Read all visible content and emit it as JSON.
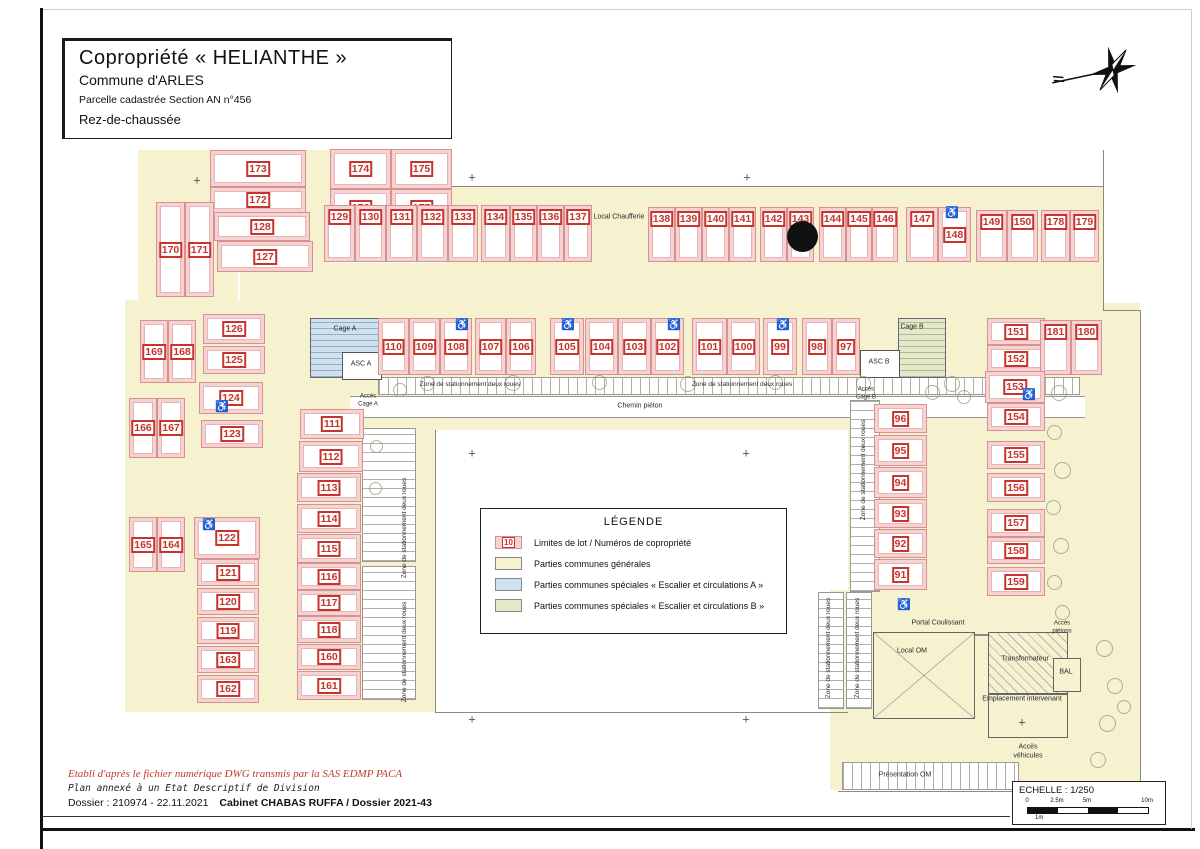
{
  "title_block": {
    "title": "Copropriété « HELIANTHE »",
    "subtitle": "Commune d'ARLES",
    "parcel": "Parcelle cadastrée Section AN n°456",
    "level": "Rez-de-chaussée"
  },
  "legend": {
    "title": "LÉGENDE",
    "items": [
      {
        "badge": "10",
        "label": "Limites de lot / Numéros de copropriété"
      },
      {
        "label": "Parties communes générales"
      },
      {
        "label": "Parties communes spéciales « Escalier et circulations A »"
      },
      {
        "label": "Parties communes spéciales « Escalier et circulations B »"
      }
    ]
  },
  "footer": {
    "line1": "Etabli d'après le fichier numérique DWG transmis par la SAS EDMP PACA",
    "line2": "Plan annexé à un Etat Descriptif de Division",
    "line3": "Dossier : 210974 - 22.11.2021",
    "line3_bold": "Cabinet CHABAS RUFFA / Dossier 2021-43"
  },
  "scale": {
    "label": "ECHELLE : 1/250",
    "ticks": [
      "0",
      "2.5m",
      "5m",
      "10m"
    ],
    "sub": "1m"
  },
  "colors": {
    "common_general": "#f6f2cf",
    "lot_fill": "#f5d3d3",
    "lot_number": "#c6342e",
    "stair_a": "#cfe0ee",
    "stair_b": "#e3e9c9"
  },
  "plan": {
    "lots_key": [
      "num",
      "x",
      "y",
      "w",
      "h",
      "labelPos"
    ],
    "lots": [
      [
        173,
        210,
        150,
        96,
        37,
        "c"
      ],
      [
        172,
        210,
        187,
        96,
        26,
        "c"
      ],
      [
        128,
        214,
        212,
        96,
        29,
        "c"
      ],
      [
        127,
        217,
        241,
        96,
        31,
        "c"
      ],
      [
        170,
        156,
        202,
        29,
        95,
        "c"
      ],
      [
        171,
        185,
        202,
        29,
        95,
        "c"
      ],
      [
        174,
        330,
        149,
        61,
        40,
        "c"
      ],
      [
        175,
        391,
        149,
        61,
        40,
        "c"
      ],
      [
        176,
        330,
        189,
        61,
        37,
        "c"
      ],
      [
        177,
        391,
        189,
        61,
        37,
        "c"
      ],
      [
        129,
        324,
        205,
        31,
        57,
        "t"
      ],
      [
        130,
        355,
        205,
        31,
        57,
        "t"
      ],
      [
        131,
        386,
        205,
        31,
        57,
        "t"
      ],
      [
        132,
        417,
        205,
        31,
        57,
        "t"
      ],
      [
        133,
        448,
        205,
        30,
        57,
        "t"
      ],
      [
        134,
        481,
        205,
        29,
        57,
        "t"
      ],
      [
        135,
        510,
        205,
        27,
        57,
        "t"
      ],
      [
        136,
        537,
        205,
        27,
        57,
        "t"
      ],
      [
        137,
        564,
        205,
        28,
        57,
        "t"
      ],
      [
        138,
        648,
        207,
        27,
        55,
        "t"
      ],
      [
        139,
        675,
        207,
        27,
        55,
        "t"
      ],
      [
        140,
        702,
        207,
        27,
        55,
        "t"
      ],
      [
        141,
        729,
        207,
        27,
        55,
        "t"
      ],
      [
        142,
        760,
        207,
        27,
        55,
        "t"
      ],
      [
        143,
        787,
        207,
        27,
        55,
        "t"
      ],
      [
        144,
        819,
        207,
        27,
        55,
        "t"
      ],
      [
        145,
        846,
        207,
        26,
        55,
        "t"
      ],
      [
        146,
        872,
        207,
        26,
        55,
        "t"
      ],
      [
        147,
        906,
        207,
        32,
        55,
        "t"
      ],
      [
        148,
        938,
        207,
        33,
        55,
        "c"
      ],
      [
        149,
        976,
        210,
        31,
        52,
        "t"
      ],
      [
        150,
        1007,
        210,
        31,
        52,
        "t"
      ],
      [
        178,
        1041,
        210,
        29,
        52,
        "t"
      ],
      [
        179,
        1070,
        210,
        29,
        52,
        "t"
      ],
      [
        169,
        140,
        320,
        28,
        63,
        "c"
      ],
      [
        168,
        168,
        320,
        28,
        63,
        "c"
      ],
      [
        126,
        203,
        314,
        62,
        30,
        "c"
      ],
      [
        125,
        203,
        346,
        62,
        28,
        "c"
      ],
      [
        124,
        199,
        382,
        64,
        32,
        "c"
      ],
      [
        123,
        201,
        420,
        62,
        28,
        "c"
      ],
      [
        166,
        129,
        398,
        28,
        60,
        "c"
      ],
      [
        167,
        157,
        398,
        28,
        60,
        "c"
      ],
      [
        165,
        129,
        517,
        28,
        55,
        "c"
      ],
      [
        164,
        157,
        517,
        28,
        55,
        "c"
      ],
      [
        122,
        194,
        517,
        66,
        42,
        "c"
      ],
      [
        121,
        197,
        559,
        62,
        27,
        "c"
      ],
      [
        120,
        197,
        588,
        62,
        27,
        "c"
      ],
      [
        119,
        197,
        617,
        62,
        27,
        "c"
      ],
      [
        163,
        197,
        646,
        62,
        27,
        "c"
      ],
      [
        162,
        197,
        675,
        62,
        28,
        "c"
      ],
      [
        111,
        300,
        409,
        64,
        30,
        "c"
      ],
      [
        112,
        299,
        441,
        64,
        31,
        "c"
      ],
      [
        113,
        297,
        473,
        64,
        29,
        "c"
      ],
      [
        114,
        297,
        504,
        64,
        29,
        "c"
      ],
      [
        115,
        297,
        534,
        64,
        29,
        "c"
      ],
      [
        116,
        297,
        563,
        64,
        27,
        "c"
      ],
      [
        117,
        297,
        590,
        64,
        26,
        "c"
      ],
      [
        118,
        297,
        616,
        64,
        27,
        "c"
      ],
      [
        160,
        297,
        644,
        64,
        26,
        "c"
      ],
      [
        161,
        297,
        671,
        64,
        29,
        "c"
      ],
      [
        110,
        378,
        318,
        31,
        57,
        "c"
      ],
      [
        109,
        409,
        318,
        31,
        57,
        "c"
      ],
      [
        108,
        440,
        318,
        32,
        57,
        "c"
      ],
      [
        107,
        475,
        318,
        31,
        57,
        "c"
      ],
      [
        106,
        506,
        318,
        30,
        57,
        "c"
      ],
      [
        105,
        550,
        318,
        34,
        57,
        "c"
      ],
      [
        104,
        585,
        318,
        33,
        57,
        "c"
      ],
      [
        103,
        618,
        318,
        33,
        57,
        "c"
      ],
      [
        102,
        651,
        318,
        33,
        57,
        "c"
      ],
      [
        101,
        692,
        318,
        35,
        57,
        "c"
      ],
      [
        100,
        727,
        318,
        33,
        57,
        "c"
      ],
      [
        99,
        763,
        318,
        34,
        57,
        "c"
      ],
      [
        98,
        802,
        318,
        30,
        57,
        "c"
      ],
      [
        97,
        832,
        318,
        28,
        57,
        "c"
      ],
      [
        96,
        874,
        404,
        53,
        29,
        "c"
      ],
      [
        95,
        874,
        435,
        53,
        31,
        "c"
      ],
      [
        94,
        874,
        467,
        53,
        31,
        "c"
      ],
      [
        93,
        874,
        499,
        53,
        29,
        "c"
      ],
      [
        92,
        874,
        529,
        53,
        29,
        "c"
      ],
      [
        91,
        874,
        559,
        53,
        31,
        "c"
      ],
      [
        151,
        987,
        318,
        58,
        27,
        "c"
      ],
      [
        152,
        987,
        345,
        58,
        27,
        "c"
      ],
      [
        181,
        1040,
        320,
        31,
        55,
        "t"
      ],
      [
        180,
        1071,
        320,
        31,
        55,
        "t"
      ],
      [
        153,
        985,
        371,
        60,
        32,
        "c"
      ],
      [
        154,
        987,
        403,
        58,
        28,
        "c"
      ],
      [
        155,
        987,
        441,
        58,
        28,
        "c"
      ],
      [
        156,
        987,
        473,
        58,
        29,
        "c"
      ],
      [
        157,
        987,
        509,
        58,
        28,
        "c"
      ],
      [
        158,
        987,
        537,
        58,
        27,
        "c"
      ],
      [
        159,
        987,
        567,
        58,
        29,
        "c"
      ]
    ],
    "zones": [
      [
        138,
        150,
        100,
        153
      ],
      [
        306,
        150,
        24,
        153
      ],
      [
        445,
        186,
        658,
        77
      ],
      [
        240,
        263,
        863,
        55
      ],
      [
        125,
        300,
        310,
        412
      ],
      [
        340,
        303,
        763,
        127
      ],
      [
        848,
        303,
        292,
        327
      ],
      [
        830,
        590,
        310,
        200
      ]
    ],
    "lines": [
      [
        445,
        186,
        658,
        1
      ],
      [
        1103,
        150,
        1,
        161
      ],
      [
        1103,
        310,
        37,
        1
      ],
      [
        1140,
        310,
        1,
        482
      ],
      [
        838,
        791,
        302,
        1
      ],
      [
        435,
        430,
        1,
        282
      ],
      [
        435,
        712,
        413,
        1
      ],
      [
        873,
        634,
        172,
        2
      ]
    ],
    "bands": [
      [
        350,
        396,
        735,
        20
      ]
    ],
    "strips": [
      [
        378,
        377,
        700,
        16,
        "h"
      ],
      [
        362,
        428,
        52,
        132,
        "v"
      ],
      [
        362,
        566,
        52,
        132,
        "v"
      ],
      [
        850,
        400,
        28,
        190,
        "v"
      ],
      [
        818,
        592,
        24,
        115,
        "v"
      ],
      [
        846,
        592,
        24,
        115,
        "v"
      ],
      [
        842,
        762,
        175,
        26,
        "h"
      ]
    ],
    "cages": [
      {
        "type": "a",
        "x": 310,
        "y": 318,
        "w": 68,
        "h": 58
      },
      {
        "type": "b",
        "x": 898,
        "y": 318,
        "w": 46,
        "h": 58
      }
    ],
    "asc_boxes": [
      [
        342,
        352,
        38,
        26
      ],
      [
        860,
        350,
        38,
        26
      ]
    ],
    "facility_boxes": [
      {
        "x": 873,
        "y": 632,
        "w": 100,
        "h": 85,
        "type": "om"
      },
      {
        "x": 988,
        "y": 632,
        "w": 78,
        "h": 60,
        "type": "transfo"
      },
      {
        "x": 988,
        "y": 694,
        "w": 78,
        "h": 42,
        "type": "plain"
      },
      {
        "x": 1053,
        "y": 658,
        "w": 26,
        "h": 32,
        "type": "plain"
      }
    ],
    "labels": [
      {
        "t": "Local Chaufferie",
        "x": 619,
        "y": 218,
        "s": 7
      },
      {
        "t": "Cage A",
        "x": 345,
        "y": 330,
        "s": 7
      },
      {
        "t": "ASC A",
        "x": 361,
        "y": 365,
        "s": 7
      },
      {
        "t": "Accès\nCage A",
        "x": 368,
        "y": 401,
        "s": 6
      },
      {
        "t": "Cage B",
        "x": 912,
        "y": 328,
        "s": 7
      },
      {
        "t": "ASC B",
        "x": 879,
        "y": 363,
        "s": 7
      },
      {
        "t": "Accès\nCage B",
        "x": 866,
        "y": 394,
        "s": 6
      },
      {
        "t": "Zone de stationnement deux roues",
        "x": 470,
        "y": 385,
        "s": 6.5
      },
      {
        "t": "Zone de stationnement deux roues",
        "x": 742,
        "y": 385,
        "s": 6.5
      },
      {
        "t": "Chemin piéton",
        "x": 640,
        "y": 407,
        "s": 7
      },
      {
        "t": "Zone de stationnement deux roues",
        "x": 405,
        "y": 528,
        "s": 6.5,
        "v": 1
      },
      {
        "t": "Zone de stationnement deux roues",
        "x": 405,
        "y": 652,
        "s": 6.5,
        "v": 1
      },
      {
        "t": "Zone de stationnement deux roues",
        "x": 864,
        "y": 470,
        "s": 6.5,
        "v": 1
      },
      {
        "t": "Zone de stationnement deux roues",
        "x": 829,
        "y": 648,
        "s": 6.5,
        "v": 1
      },
      {
        "t": "Zone de stationnement deux roues",
        "x": 858,
        "y": 648,
        "s": 6.5,
        "v": 1
      },
      {
        "t": "Portal Coulissant",
        "x": 938,
        "y": 624,
        "s": 7
      },
      {
        "t": "Local OM",
        "x": 912,
        "y": 652,
        "s": 7
      },
      {
        "t": "Transformateur",
        "x": 1025,
        "y": 660,
        "s": 7
      },
      {
        "t": "Emplacement intervenant",
        "x": 1022,
        "y": 700,
        "s": 7
      },
      {
        "t": "Accès\npiétons",
        "x": 1062,
        "y": 628,
        "s": 6
      },
      {
        "t": "BAL",
        "x": 1066,
        "y": 673,
        "s": 7
      },
      {
        "t": "Accès\nvéhicules",
        "x": 1028,
        "y": 752,
        "s": 7
      },
      {
        "t": "Présentation OM",
        "x": 905,
        "y": 776,
        "s": 7
      }
    ],
    "hc_icons": [
      [
        455,
        320
      ],
      [
        561,
        320
      ],
      [
        667,
        320
      ],
      [
        776,
        320
      ],
      [
        945,
        208
      ],
      [
        215,
        402
      ],
      [
        202,
        520
      ],
      [
        1022,
        390
      ],
      [
        897,
        600
      ]
    ],
    "plus_marks": [
      [
        197,
        180
      ],
      [
        472,
        177
      ],
      [
        747,
        177
      ],
      [
        472,
        453
      ],
      [
        746,
        453
      ],
      [
        472,
        719
      ],
      [
        746,
        719
      ],
      [
        1022,
        722
      ]
    ],
    "trees": [
      [
        420,
        376,
        13
      ],
      [
        505,
        375,
        14
      ],
      [
        592,
        375,
        13
      ],
      [
        680,
        376,
        14
      ],
      [
        768,
        375,
        13
      ],
      [
        856,
        376,
        13
      ],
      [
        944,
        376,
        14
      ],
      [
        1051,
        385,
        14
      ],
      [
        1047,
        425,
        13
      ],
      [
        1054,
        462,
        15
      ],
      [
        1046,
        500,
        13
      ],
      [
        1053,
        538,
        14
      ],
      [
        1047,
        575,
        13
      ],
      [
        1055,
        605,
        13
      ],
      [
        1096,
        640,
        15
      ],
      [
        1107,
        678,
        14
      ],
      [
        1099,
        715,
        15
      ],
      [
        1090,
        752,
        14
      ],
      [
        1117,
        700,
        12
      ],
      [
        393,
        383,
        12
      ],
      [
        925,
        385,
        13
      ],
      [
        957,
        390,
        12
      ],
      [
        370,
        440,
        11
      ],
      [
        369,
        482,
        11
      ]
    ],
    "black_dot": {
      "x": 787,
      "y": 221,
      "d": 31
    }
  }
}
